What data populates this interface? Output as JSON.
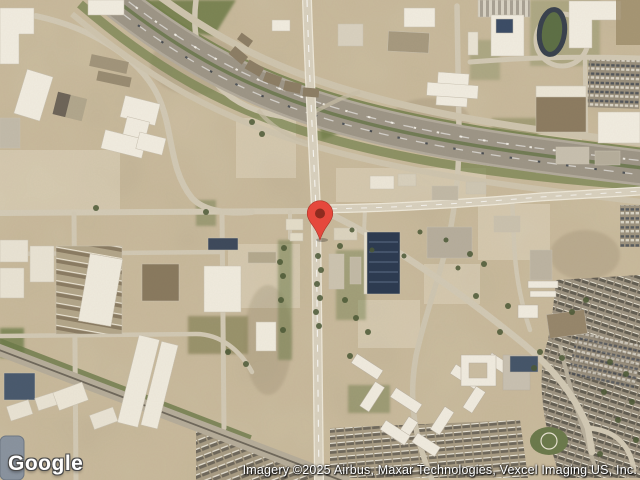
{
  "map": {
    "view_type": "satellite",
    "logo_text": "Google",
    "attribution_text": "Imagery ©2025 Airbus, Maxar Technologies, Vexcel Imaging US, Inc.",
    "marker": {
      "color": "#E5483C",
      "dot_color": "#8E2B1F"
    },
    "palette": {
      "terrain": "#CDBEA1",
      "highway": "#9E9687",
      "road": "#D9D1BE",
      "green": "#75814D",
      "building_light": "#F1ECE0",
      "building_dark_roof": "#2D3B51"
    }
  }
}
